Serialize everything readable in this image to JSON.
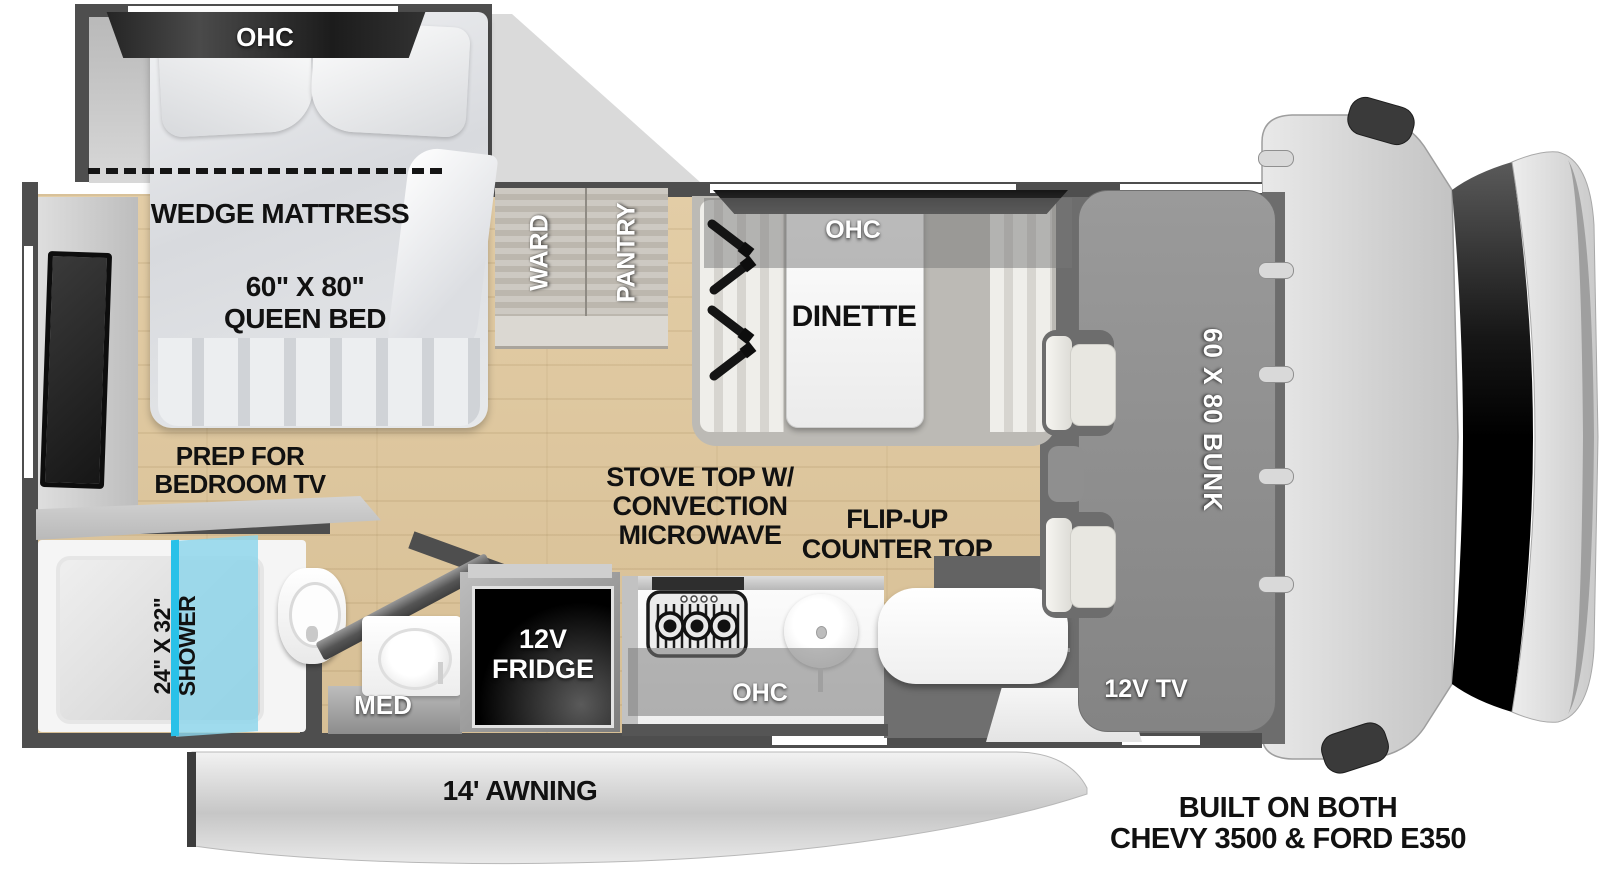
{
  "bedroom": {
    "ohc": "OHC",
    "wedge_mattress": "WEDGE MATTRESS",
    "bed_size": "60\" X 80\"",
    "bed_type": "QUEEN BED",
    "prep_line1": "PREP FOR",
    "prep_line2": "BEDROOM TV"
  },
  "bath": {
    "shower_line1": "24\" X 32\"",
    "shower_line2": "SHOWER",
    "med": "MED"
  },
  "storage": {
    "ward": "WARD",
    "pantry": "PANTRY"
  },
  "dinette": {
    "ohc": "OHC",
    "label": "DINETTE"
  },
  "kitchen": {
    "stove_line1": "STOVE TOP W/",
    "stove_line2": "CONVECTION",
    "stove_line3": "MICROWAVE",
    "flip_line1": "FLIP-UP",
    "flip_line2": "COUNTER TOP",
    "fridge_line1": "12V",
    "fridge_line2": "FRIDGE",
    "ohc": "OHC"
  },
  "cab": {
    "bunk": "60 X 80 BUNK",
    "tv": "12V TV"
  },
  "exterior": {
    "awning": "14' AWNING",
    "chassis_line1": "BUILT ON BOTH",
    "chassis_line2": "CHEVY 3500 & FORD E350"
  },
  "colors": {
    "wall": "#4e4e4e",
    "floor": "#dcc59e",
    "cab_floor": "#6d6d6d",
    "bunk": "#8f8f8f",
    "shower_glass": "#35c4e8",
    "label_black": "#111111"
  }
}
